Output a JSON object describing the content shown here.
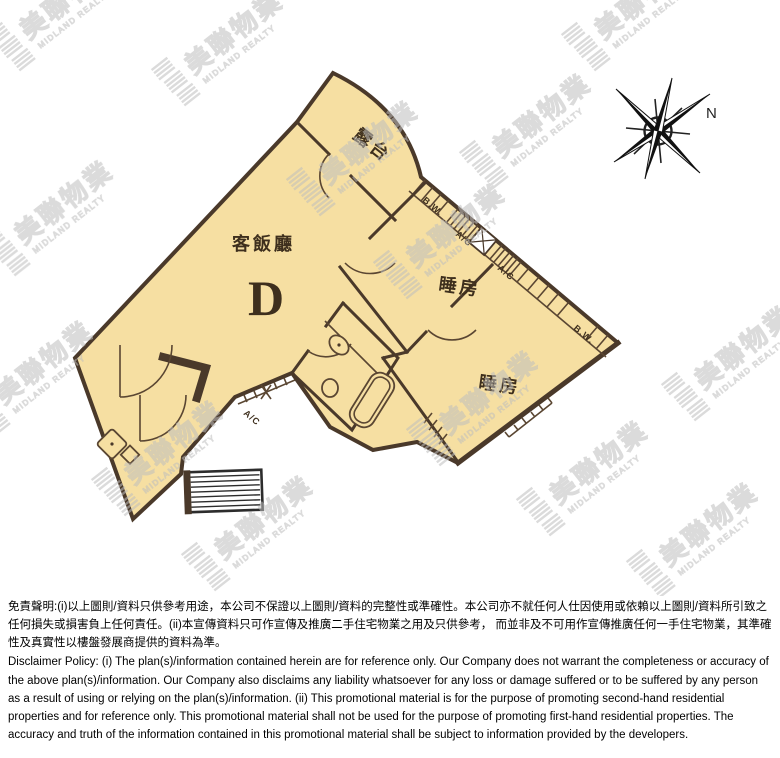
{
  "plan": {
    "unit": "D",
    "living_dining": "客飯廳",
    "balcony": "露台",
    "bedroom1": "睡房",
    "bedroom2": "睡房",
    "bay_window_1": "B.W.",
    "bay_window_2": "B.W.",
    "ac_1": "A/C",
    "ac_2": "A/C",
    "ac_3": "A/C"
  },
  "compass": {
    "north": "N"
  },
  "watermark": {
    "brand_zh": "美聯物業",
    "brand_en": "MIDLAND REALTY"
  },
  "colors": {
    "room_fill": "#f6dfa2",
    "wall": "#4a392a",
    "watermark": "#bdbdbd",
    "background": "#ffffff"
  },
  "disclaimer": {
    "zh": "免責聲明:(i)以上圖則/資料只供參考用途，本公司不保證以上圖則/資料的完整性或準確性。本公司亦不就任何人仕因使用或依賴以上圖則/資料所引致之任何損失或損害負上任何責任。(ii)本宣傳資料只可作宣傳及推廣二手住宅物業之用及只供參考， 而並非及不可用作宣傳推廣任何一手住宅物業，其準確性及真實性以樓盤發展商提供的資料為準。",
    "en": "Disclaimer Policy: (i) The plan(s)/information contained herein are for reference only. Our Company does not warrant the completeness or accuracy of the above plan(s)/information. Our Company also disclaims any liability whatsoever for any loss or damage suffered or to be suffered by any person as a result of using or relying on the plan(s)/information. (ii) This promotional material is for the purpose of promoting second-hand residential properties and for reference only. This promotional material shall not be used for the purpose of promoting first-hand residential properties. The accuracy and truth of the information contained in this promotional material shall be subject to information provided by the developers."
  }
}
